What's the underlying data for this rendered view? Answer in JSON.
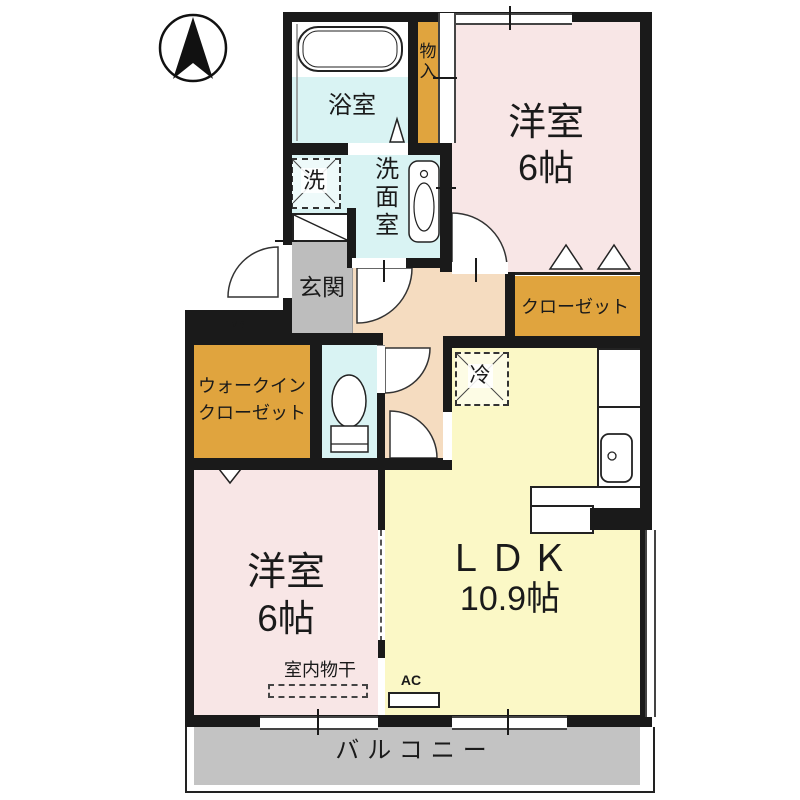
{
  "palette": {
    "wall": "#1a1a1a",
    "room_pink": "#f8e6e6",
    "room_yellow": "#fbf8c6",
    "room_cyan": "#d9f3f3",
    "hall_peach": "#f5dcc0",
    "closet_orange": "#e0a43e",
    "genkan_gray": "#bdbdbd",
    "balcony_gray": "#c3c3c3"
  },
  "icons": {
    "compass": "north-arrow-icon"
  },
  "labels": {
    "bath": "浴室",
    "storage": "物入",
    "bedroom_top_name": "洋室",
    "bedroom_top_size": "6帖",
    "washer": "洗",
    "washroom": "洗面室",
    "genkan": "玄関",
    "meter_box": "MB",
    "closet": "クローゼット",
    "wic_line1": "ウォークイン",
    "wic_line2": "クローゼット",
    "fridge": "冷",
    "ldk_name": "ＬＤＫ",
    "ldk_size": "10.9帖",
    "bedroom_bottom_name": "洋室",
    "bedroom_bottom_size": "6帖",
    "indoor_drying": "室内物干",
    "ac": "AC",
    "balcony": "バルコニー"
  }
}
